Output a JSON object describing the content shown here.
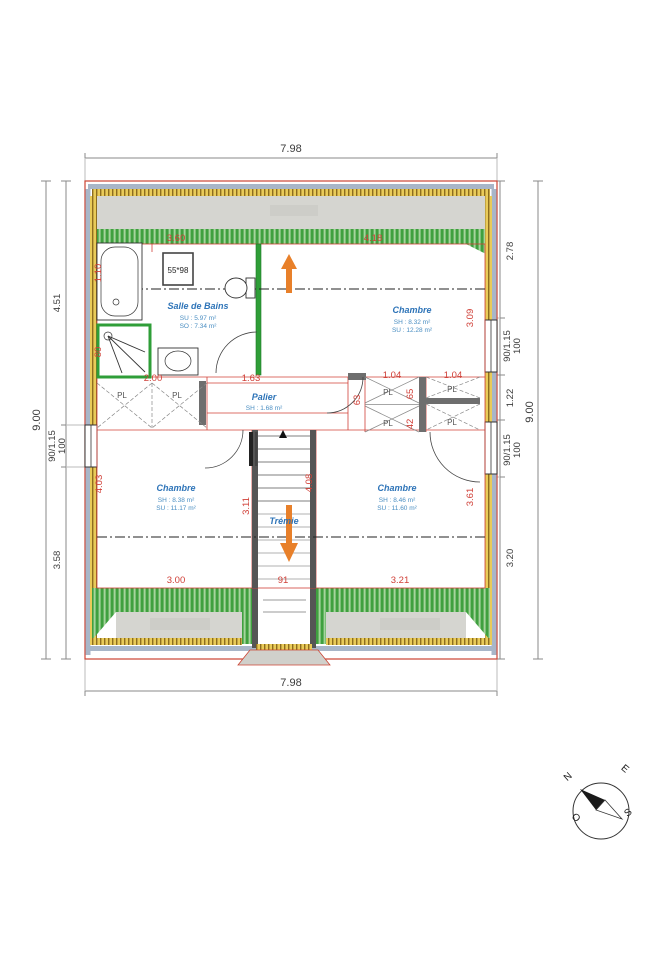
{
  "plan_title": "Plan d'étage",
  "dims_black": {
    "top": "7.98",
    "bottom": "7.98",
    "left_outer": "9.00",
    "right_outer": "9.00",
    "left_seg1": "4.51",
    "left_win": "90/1.15",
    "left_win_h": "100",
    "left_seg2": "3.58",
    "right_seg1": "2.78",
    "right_win1": "90/1.15",
    "right_win1_h": "100",
    "right_seg2": "1.22",
    "right_win2": "90/1.15",
    "right_win2_h": "100",
    "right_seg3": "3.20"
  },
  "dims_red": {
    "d360": "3.60",
    "d418": "4.18",
    "d110": "1.10",
    "d80": "80",
    "d200": "2.00",
    "d163": "1.63",
    "d104a": "1.04",
    "d104b": "1.04",
    "d65": "65",
    "d42": "42",
    "d63": "63",
    "d309": "3.09",
    "d361": "3.61",
    "d403": "4.03",
    "d311": "3.11",
    "d408": "4.08",
    "d300": "3.00",
    "d91": "91",
    "d321": "3.21"
  },
  "rooms": {
    "bathroom": {
      "name": "Salle de Bains",
      "line1": "SU : 5.97 m²",
      "line2": "SO : 7.34 m²"
    },
    "bedroom_ne": {
      "name": "Chambre",
      "line1": "SH : 8.32 m²",
      "line2": "SU : 12.28 m²"
    },
    "landing": {
      "name": "Palier",
      "line1": "SH : 1.68 m²"
    },
    "bedroom_sw": {
      "name": "Chambre",
      "line1": "SH : 8.38 m²",
      "line2": "SU : 11.17 m²"
    },
    "bedroom_se": {
      "name": "Chambre",
      "line1": "SH : 8.46 m²",
      "line2": "SU : 11.60 m²"
    },
    "stairwell": {
      "name": "Trémie"
    }
  },
  "closet_label": "PL",
  "fixtures": {
    "velux": "55*98"
  },
  "compass": {
    "n": "N",
    "e": "E",
    "s": "S",
    "o": "O"
  },
  "colors": {
    "dim_red": "#d04038",
    "room_blue": "#2e74b8",
    "wall_green": "#2f9e38",
    "hatch_yellow": "#e9cb59",
    "hatch_green": "#3fa03f",
    "band_gray": "#d5d5d0",
    "band_bluegray": "#a8b6c8",
    "arrow_orange": "#e8802a"
  }
}
